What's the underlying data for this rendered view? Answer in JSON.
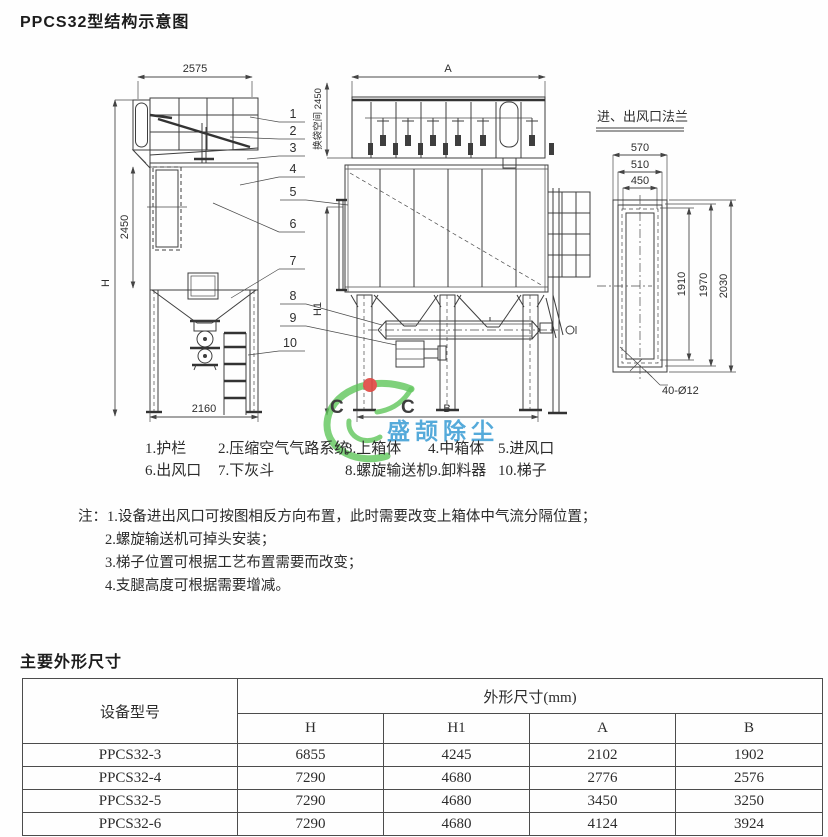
{
  "page": {
    "title": "PPCS32型结构示意图",
    "dims_section_title": "主要外形尺寸"
  },
  "diagram": {
    "flange_title": "进、出风口法兰",
    "labels": {
      "dim_2575": "2575",
      "dim_H": "H",
      "dim_2450": "2450",
      "dim_2160": "2160",
      "dim_A": "A",
      "dim_bag_space": "换袋空间 2450",
      "dim_H1": "H1",
      "dim_B": "B",
      "dim_570": "570",
      "dim_510": "510",
      "dim_450": "450",
      "dim_1910": "1910",
      "dim_1970": "1970",
      "dim_2030": "2030",
      "bolt_note": "40-Ø12"
    },
    "callouts": [
      "1",
      "2",
      "3",
      "4",
      "5",
      "6",
      "7",
      "8",
      "9",
      "10"
    ]
  },
  "legend": {
    "items": [
      "1.护栏",
      "2.压缩空气气路系统",
      "3.上箱体",
      "4.中箱体",
      "5.进风口",
      "6.出风口",
      "7.下灰斗",
      "8.螺旋输送机",
      "9.卸料器",
      "10.梯子"
    ]
  },
  "notes": {
    "prefix": "注：",
    "lines": [
      "1.设备进出风口可按图相反方向布置，此时需要改变上箱体中气流分隔位置；",
      "2.螺旋输送机可掉头安装；",
      "3.梯子位置可根据工艺布置需要而改变；",
      "4.支腿高度可根据需要增减。"
    ]
  },
  "watermark": {
    "text": "盛颉除尘",
    "letters": "C C",
    "colors": {
      "green": "#5cc457",
      "red": "#e04a44",
      "yellow": "#f2d327",
      "blue": "#47a3d8"
    }
  },
  "table": {
    "col1_header": "设备型号",
    "group_header": "外形尺寸(mm)",
    "sub_headers": [
      "H",
      "H1",
      "A",
      "B"
    ],
    "rows": [
      {
        "model": "PPCS32-3",
        "values": [
          "6855",
          "4245",
          "2102",
          "1902"
        ]
      },
      {
        "model": "PPCS32-4",
        "values": [
          "7290",
          "4680",
          "2776",
          "2576"
        ]
      },
      {
        "model": "PPCS32-5",
        "values": [
          "7290",
          "4680",
          "3450",
          "3250"
        ]
      },
      {
        "model": "PPCS32-6",
        "values": [
          "7290",
          "4680",
          "4124",
          "3924"
        ]
      }
    ]
  }
}
